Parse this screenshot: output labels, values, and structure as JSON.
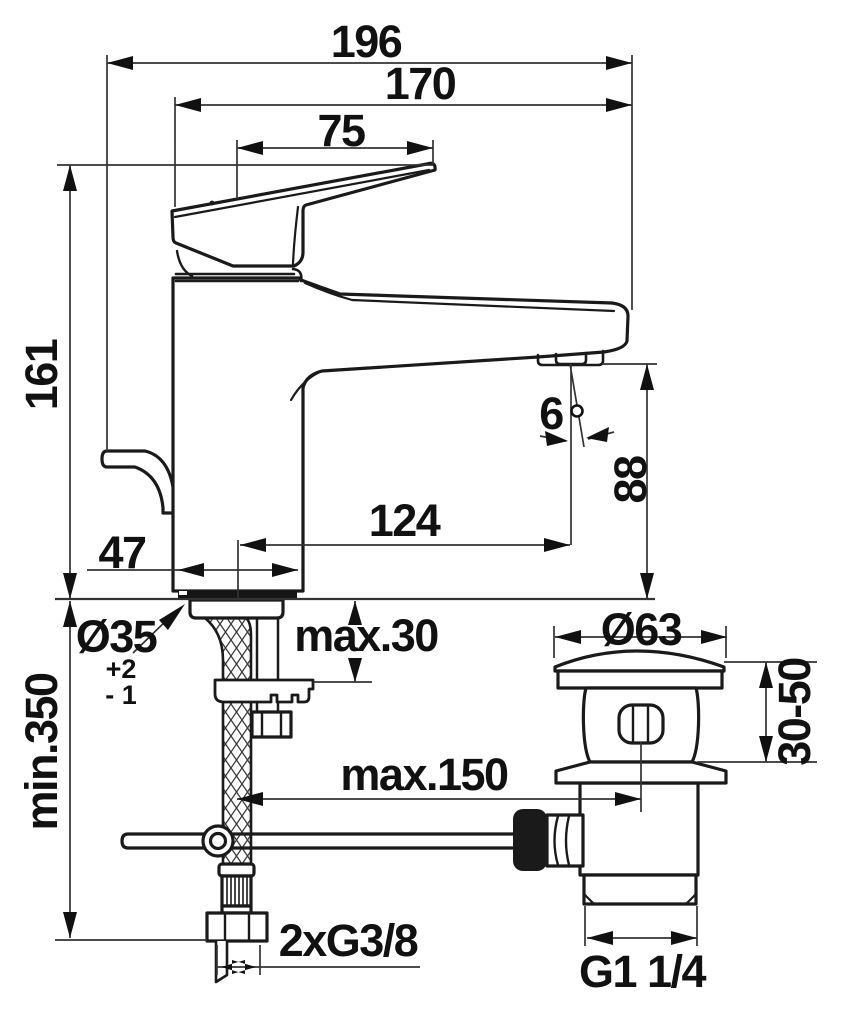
{
  "drawing": {
    "dims": {
      "d196": "196",
      "d170": "170",
      "d75": "75",
      "d161": "161",
      "d47": "47",
      "d124": "124",
      "d88": "88",
      "angle6": "6",
      "dia35": "Ø35",
      "tol_plus": "+2",
      "tol_minus": "- 1",
      "min350": "min.350",
      "max30": "max.30",
      "max150": "max.150",
      "thread_supply": "2xG3/8",
      "dia63": "Ø63",
      "deck_range": "30-50",
      "thread_waste": "G1 1/4"
    }
  }
}
